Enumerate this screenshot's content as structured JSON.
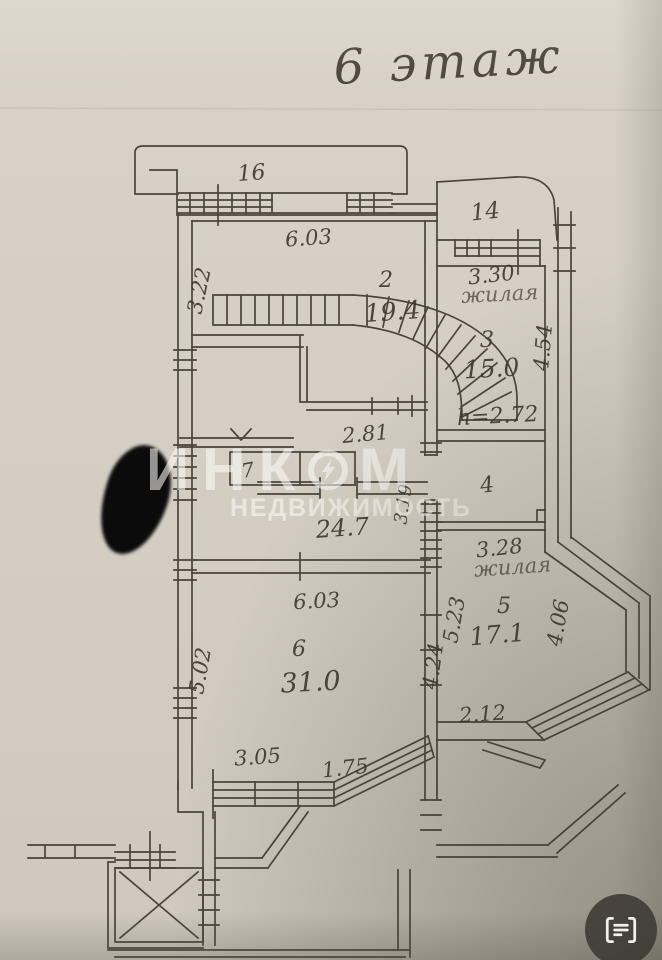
{
  "title": "6 этаж",
  "plan": {
    "rooms": {
      "r16": {
        "number": "16"
      },
      "r14": {
        "number": "14"
      },
      "r2": {
        "number": "2",
        "area": "19.4"
      },
      "r3": {
        "number": "3",
        "area": "15.0",
        "pencil": "жилая"
      },
      "r4": {
        "number": "4"
      },
      "r5": {
        "number": "5",
        "area": "17.1",
        "pencil": "жилая"
      },
      "r6": {
        "number": "6",
        "area": "31.0"
      },
      "r7": {
        "number": "7"
      }
    },
    "dims": {
      "room2_top": "6.03",
      "room2_left": "3.22",
      "room3_top": "3.30",
      "room3_right": "4.54",
      "height_note": "h=2.72",
      "hall_top": "2.81",
      "hall_area": "24.7",
      "hall_right": "3.19",
      "room5_top": "3.28",
      "room5_left": "5.23",
      "room5_right": "4.06",
      "room5_bottom": "2.12",
      "room6_top": "6.03",
      "room6_left": "5.02",
      "room6_right": "4.24",
      "room6_bottom_left": "3.05",
      "room6_bottom_right": "1.75"
    }
  },
  "watermark": {
    "brand_prefix": "ИНК",
    "brand_suffix": "М",
    "subtitle": "НЕДВИЖИМОСТЬ"
  },
  "colors": {
    "paper": "#d5cfc3",
    "ink": "#3c362b",
    "pencil": "#aba295",
    "watermark": "#fbfaf6",
    "redaction": "#0b0b0b",
    "button_bg": "#3c3932"
  }
}
